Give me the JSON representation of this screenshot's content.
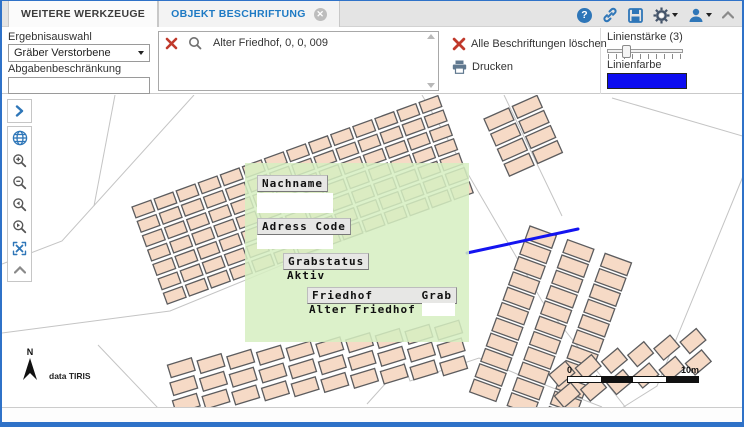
{
  "tabs": {
    "items": [
      {
        "label": "WEITERE WERKZEUGE",
        "active": false
      },
      {
        "label": "OBJEKT BESCHRIFTUNG",
        "active": true
      }
    ],
    "close_glyph": "✕"
  },
  "header": {
    "icons": [
      "help",
      "link",
      "save",
      "settings",
      "user",
      "collapse-toolbar"
    ],
    "help_glyph": "?"
  },
  "panel_left": {
    "select_label": "Ergebnisauswahl",
    "select_value": "Gräber Verstorbene",
    "input_label": "Abgabenbeschränkung",
    "input_value": ""
  },
  "results": {
    "item": "Alter Friedhof, 0, 0, 009"
  },
  "actions": {
    "clear_label": "Alle Beschriftungen löschen",
    "print_label": "Drucken"
  },
  "line_settings": {
    "width_label": "Linienstärke (3)",
    "width_percent": 20,
    "color_label": "Linienfarbe",
    "color": "#0d0df0"
  },
  "map": {
    "attribution": "data TIRIS",
    "north_label": "N",
    "scale": {
      "left": "0",
      "right": "10m"
    },
    "overlay": {
      "nachname_label": "Nachname",
      "nachname_value": "",
      "adress_code_label": "Adress Code",
      "adress_code_value": "",
      "grabstatus_label": "Grabstatus",
      "grabstatus_value": "Aktiv",
      "friedhof_label": "Friedhof",
      "grab_label": "Grab",
      "friedhof_value": "Alter Friedhof",
      "grab_value": ""
    },
    "graphics": {
      "plot_fill": "#f6dac6",
      "plot_stroke": "#5c5c5e",
      "boundary_color": "#c4c4c4",
      "blue_line": {
        "points": "465,158 576,134",
        "color": "#1414f0",
        "width": 3
      },
      "boundaries": [
        "192,0 60,146 0,169",
        "113,0 92,111",
        "0,238 168,216 368,134",
        "96,250 156,313",
        "420,0 540,206 624,313",
        "502,0 560,121",
        "610,3 744,42",
        "744,74 655,291 620,313",
        "365,309 402,268 408,286 477,263 515,279 600,312"
      ],
      "blocks": [
        {
          "x": 130,
          "y": 112,
          "rot": -20,
          "rows": 7,
          "cols": 14,
          "cw": 20,
          "ch": 11.5,
          "gx": 3.5,
          "gy": 3.8,
          "cellRot": 0
        },
        {
          "x": 482,
          "y": 24,
          "rot": -24,
          "rows": 4,
          "cols": 2,
          "cw": 27,
          "ch": 13,
          "gx": 4,
          "gy": 3.5,
          "cellRot": 0
        },
        {
          "x": 528,
          "y": 131,
          "rot": 20,
          "rows": 11,
          "cols": 3,
          "cw": 28,
          "ch": 13.5,
          "gx": 12,
          "gy": 2.8,
          "cellRot": 0
        },
        {
          "x": 166,
          "y": 268,
          "rot": -8,
          "rows": 3,
          "cols": 10,
          "cw": 25,
          "ch": 13,
          "gx": 5,
          "gy": 5,
          "cellRot": -9
        },
        {
          "x": 548,
          "y": 274,
          "rot": -14,
          "rows": 2,
          "cols": 6,
          "cw": 21,
          "ch": 15,
          "gx": 6,
          "gy": 7,
          "cellRot": -26
        }
      ]
    }
  }
}
